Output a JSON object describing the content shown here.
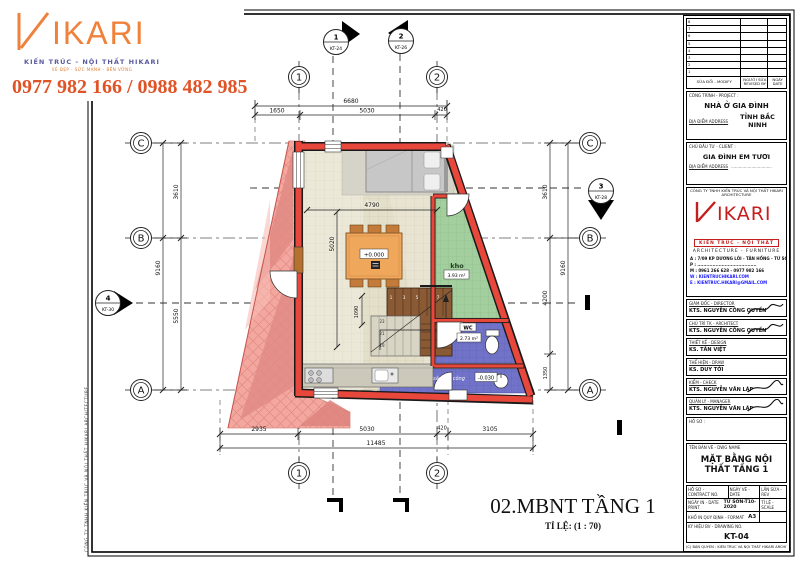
{
  "branding": {
    "logo_text": "IKARI",
    "logo_subtitle": "KIẾN TRÚC - NỘI THẤT HIKARI",
    "logo_tagline": "VẺ ĐẸP - SỨC MẠNH - BỀN VỮNG",
    "phone_numbers": "0977 982 166 / 0988 482 985"
  },
  "colors": {
    "accent_orange": "#F0813A",
    "phone_red": "#E05326",
    "wall_red": "#E8473B",
    "hatch_pink": "#F3A79F",
    "floor_beige": "#E4DFC9",
    "room_green": "#A3CF9E",
    "room_blue": "#7173C9",
    "stair_brown": "#8A5A35",
    "table_orange": "#EFA75B",
    "logo_red": "#C41E1E"
  },
  "plan": {
    "grid_rows": [
      "C",
      "B",
      "A"
    ],
    "grid_cols": [
      "1",
      "2"
    ],
    "section_markers": [
      {
        "num": "1",
        "ref": "KT-24"
      },
      {
        "num": "2",
        "ref": "KT-26"
      },
      {
        "num": "3",
        "ref": "KT-28"
      },
      {
        "num": "4",
        "ref": "KT-30"
      }
    ],
    "dims": {
      "top_total": "6680",
      "top": [
        "1650",
        "5030",
        "420"
      ],
      "bottom": [
        "2935",
        "5030",
        "420",
        "3105"
      ],
      "bottom_total": "11485",
      "left": [
        "3610",
        "5550"
      ],
      "left_total": "9160",
      "right": [
        "3610",
        "4200",
        "1350"
      ],
      "right_total": "9160",
      "interior_width": "4790",
      "interior_height": "5020",
      "stair_width": "1090"
    },
    "rooms": {
      "storage_name": "kho",
      "storage_area": "3.93 m²",
      "wc_name": "WC",
      "wc_area": "2.73 m²",
      "laundry_name": "sân gia công",
      "laundry_level": "-0.030",
      "main_level": "+0.000"
    },
    "stair_numbers": [
      "1",
      "3",
      "5",
      "7",
      "23",
      "21",
      "19"
    ],
    "caption_title": "02.MBNT TẦNG 1",
    "caption_scale": "TỈ LỆ: (1 : 70)"
  },
  "titleblock": {
    "revision": {
      "row_numbers": [
        "8",
        "7",
        "6",
        "5",
        "4",
        "3",
        "2",
        "1"
      ],
      "col_modify": "SỬA ĐỔI - MODIFY",
      "col_revised_by": "NGƯỜI SỬA REVISED BY",
      "col_date": "NGÀY DATE"
    },
    "project_label": "CÔNG TRÌNH - PROJECT :",
    "project_name": "NHÀ Ở GIA ĐÌNH",
    "project_address_label": "ĐỊA ĐIỂM ADDRESS",
    "project_address": "TỈNH BẮC NINH",
    "client_label": "CHỦ ĐẦU TƯ - CLIENT :",
    "client_name": "GIA ĐÌNH EM TƯƠI",
    "client_address_label": "ĐỊA ĐIỂM ADDRESS",
    "client_address": "................................",
    "company_name": "CÔNG TY TNHH KIẾN TRÚC VÀ NỘI THẤT HIKARI ARCHITECTURE",
    "company_logo_text": "IKARI",
    "company_logo_sub": "KIẾN TRÚC - NỘI THẤT",
    "company_tagline": "ARCHITECTURE - FURNITURE",
    "company_address": "A : 7/09 KP DƯƠNG LÔI - TÂN HỒNG - TỪ SƠN - BN",
    "company_phone_line": "P : .......................................",
    "company_mobile": "M : 0961 266 628 - 0977 982 166",
    "company_website": "W : KIENTRUCHIKARI.COM",
    "company_email": "E : KIENTRUC.HIKARI@GMAIL.COM",
    "signers": [
      {
        "role": "GIÁM ĐỐC - DIRECTOR",
        "name": "KTS. NGUYỄN CÔNG QUYỀN"
      },
      {
        "role": "CHỦ TRÌ TK - ARCHITECT",
        "name": "KTS. NGUYỄN CÔNG QUYỀN"
      },
      {
        "role": "THIẾT KẾ - DESIGN",
        "name": "KS. TẤN VIỆT"
      },
      {
        "role": "THỂ HIỆN - DRAW",
        "name": "KS. DUY TỚI"
      },
      {
        "role": "KIỂM - CHECK",
        "name": "KTS. NGUYỄN VĂN LẬP"
      },
      {
        "role": "QUẢN LÝ - MANAGER",
        "name": "KTS. NGUYỄN VĂN LẬP"
      }
    ],
    "dossier_label": "HỒ SƠ :",
    "dwg_name_label": "TÊN BẢN VẼ - DWG NAME",
    "dwg_name": "MẶT BẰNG NỘI THẤT TẦNG 1",
    "contract_label": "HỒ SƠ - CONTRACT NO.",
    "date_label": "NGÀY VẼ - DATE",
    "rev_label": "LẦN SỬA - REV",
    "print_label": "NGÀY IN - DATE PRINT",
    "print_value": "TỪ SƠN-T10-2020",
    "scale_label": "TỈ LỆ - SCALE",
    "format_label": "KHỔ IN QUY ĐỊNH - FORMAT",
    "format_value": "A3",
    "dwgno_label": "KÝ HIỆU BV - DRAWING NO.",
    "dwgno_value": "KT-04",
    "copyright": "(C) BẢN QUYỀN : KIẾN TRÚC VÀ NỘI THẤT HIKARI ARCHITECTURE"
  },
  "frame": {
    "side_text": "CÔNG TY TNHH KIẾN TRÚC VÀ NỘI THẤT HIKARI ARCHITECTURE"
  }
}
